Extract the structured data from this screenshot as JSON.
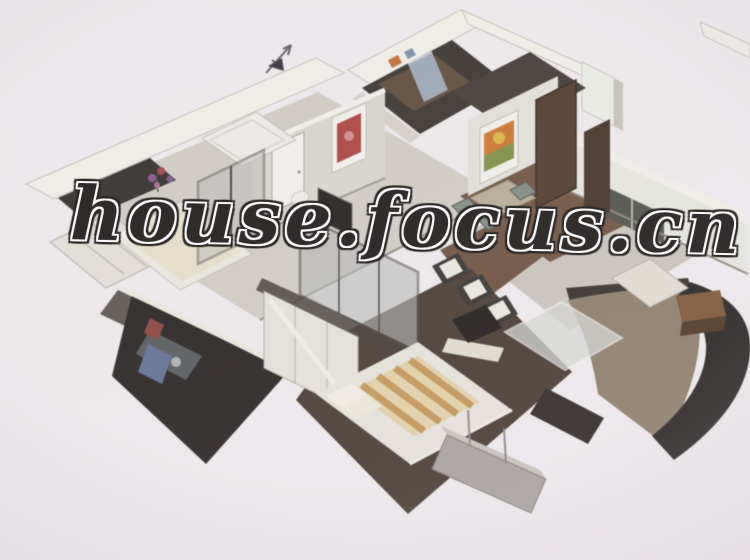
{
  "scene": {
    "description": "Blurry 3D isometric cutaway rendering of a two-bedroom apartment model on a pale background, with balconies, kitchen, dining and living areas"
  },
  "watermark": {
    "text": "house.focus.cn",
    "fill": "#171512",
    "outline": "#ffffff"
  },
  "compass": {
    "icon": "north-arrow"
  },
  "palette": {
    "background": "#f2eef0",
    "wall_top": "#f5f3ec",
    "wall_face": "#dcd9d0",
    "wall_face_dark": "#56504a",
    "floor_light": "#d3cfc5",
    "floor_living": "#cac7bc",
    "floor_wood_red": "#6e4c36",
    "floor_master_brown": "#3f3126",
    "dark_structure": "#1d1a17",
    "balcony_floor_tan": "#8c7a62",
    "kitchen_cabinet": "#332d27",
    "door_wood": "#4a3120",
    "art_red": "#b43b35",
    "art_orange": "#d4711f",
    "art_green": "#7a8f3a",
    "appliance_blue": "#9aa7b8",
    "bed_stripe_tan": "#c08a3e",
    "glass": "#b5b9b7"
  }
}
